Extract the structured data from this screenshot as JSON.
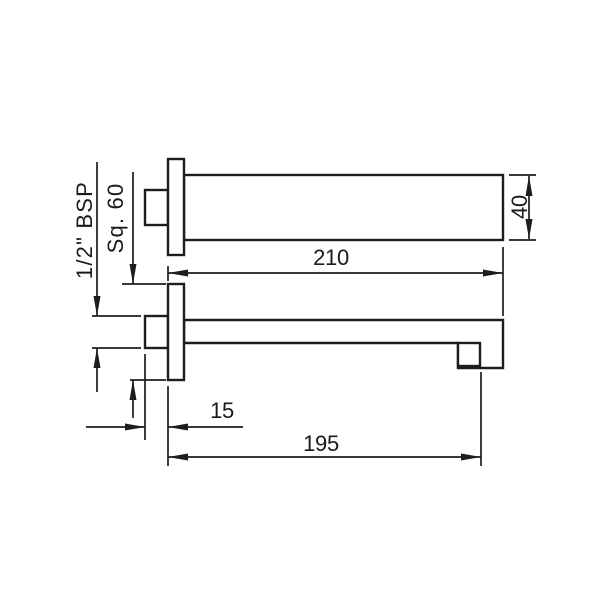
{
  "drawing": {
    "type": "technical-dimension-drawing",
    "subject": "wall-mounted square bath spout, plan view and side elevation",
    "colors": {
      "line": "#1d1d1d",
      "text": "#1a1a1a",
      "background": "#ffffff"
    },
    "dimensions": {
      "thread": "1/2\" BSP",
      "flange_square": "Sq. 60",
      "spout_width": "40",
      "overall_length": "210",
      "thread_length": "15",
      "spout_reach": "195"
    }
  }
}
